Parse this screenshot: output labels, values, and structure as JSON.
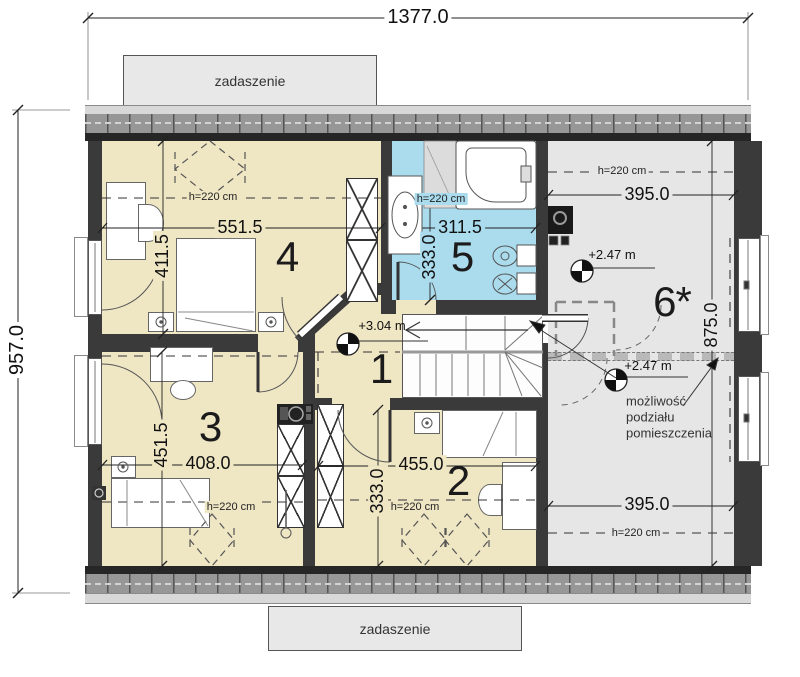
{
  "drawing": {
    "overall_width": "1377.0",
    "overall_height": "957.0",
    "canopy_top": "zadaszenie",
    "canopy_bottom": "zadaszenie"
  },
  "rooms": {
    "r1": {
      "num": "1",
      "level": "+3.04 m"
    },
    "r2": {
      "num": "2",
      "w": "455.0",
      "h": "333.0",
      "ceil": "h=220 cm"
    },
    "r3": {
      "num": "3",
      "w": "408.0",
      "h": "451.5",
      "ceil": "h=220 cm"
    },
    "r4": {
      "num": "4",
      "w": "551.5",
      "h": "411.5",
      "ceil": "h=220 cm"
    },
    "r5": {
      "num": "5",
      "w": "311.5",
      "h": "333.0",
      "ceil": "h=220 cm"
    },
    "r6": {
      "num": "6*",
      "w_top": "395.0",
      "w_bottom": "395.0",
      "h": "875.0",
      "ceil_top": "h=220 cm",
      "ceil_bottom": "h=220 cm",
      "level_top": "+2.47 m",
      "level_mid": "+2.47 m",
      "note1": "możliwość",
      "note2": "podziału",
      "note3": "pomieszczenia"
    }
  },
  "colors": {
    "room_beige": "#efe6c4",
    "bathroom_blue": "#aadcee",
    "attic_gray": "#e6e6e6",
    "wall_dark": "#3a3a3a"
  }
}
